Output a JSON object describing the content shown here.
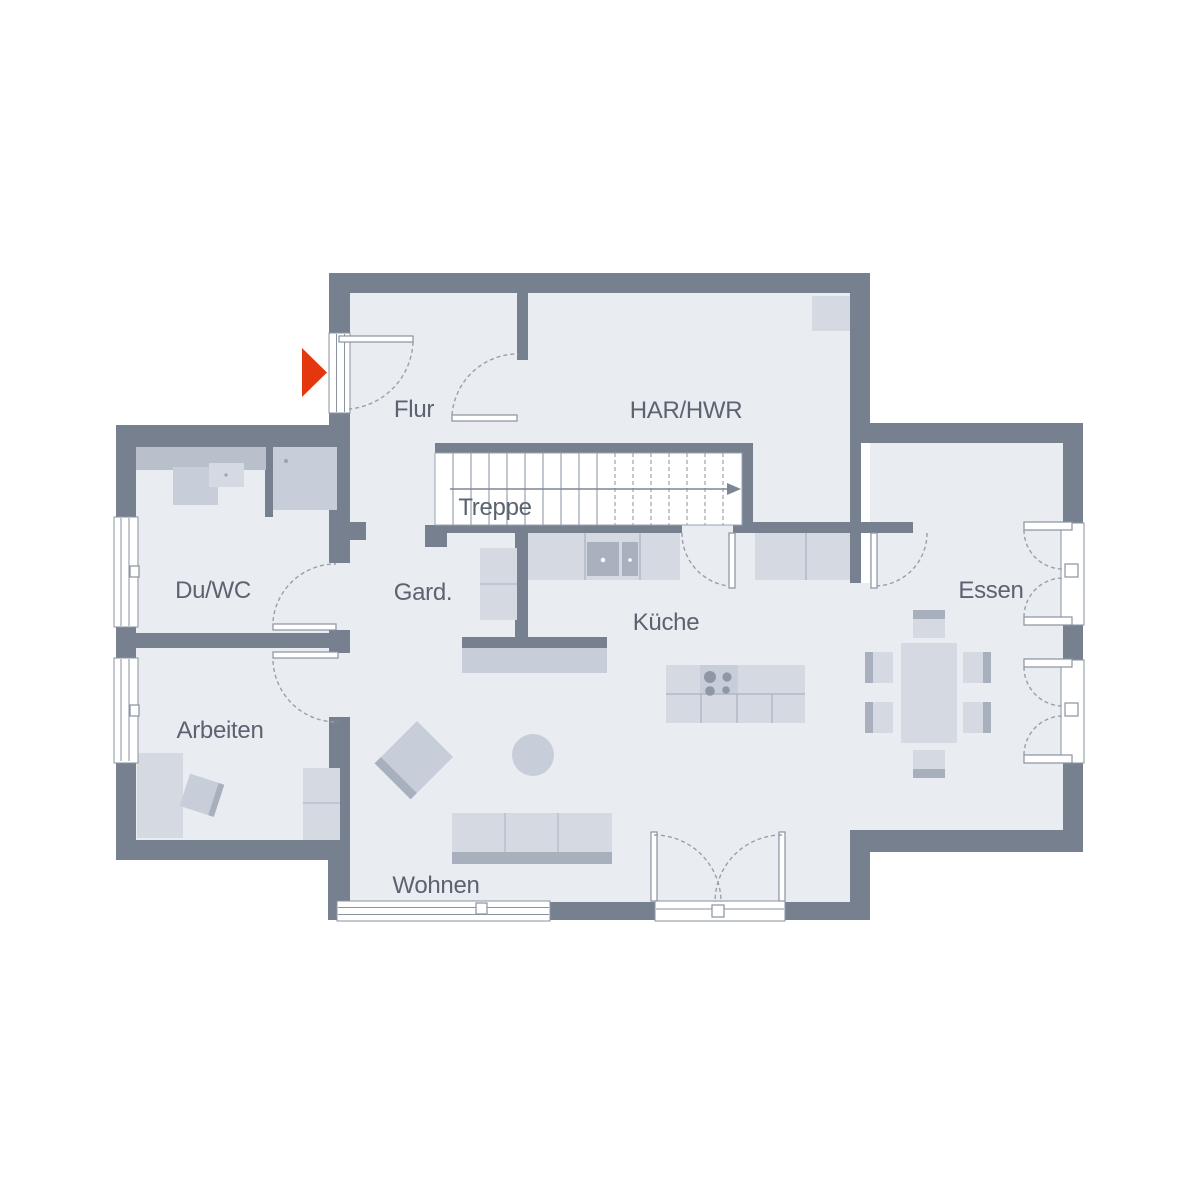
{
  "plan": {
    "type": "ground-floor-plan",
    "rooms": {
      "flur": "Flur",
      "har": "HAR/HWR",
      "treppe": "Treppe",
      "duwc": "Du/WC",
      "gard": "Gard.",
      "kueche": "Küche",
      "essen": "Essen",
      "arbeiten": "Arbeiten",
      "wohnen": "Wohnen"
    },
    "colors": {
      "wall": "#77808f",
      "floor": "#e9ecf1",
      "furniture_light": "#d5d9e2",
      "furniture_mid": "#c8ced9",
      "furniture_dark": "#a9b0bd",
      "counter": "#b9c0cb",
      "appliance": "#aab1be",
      "accent_entrance": "#e5370e",
      "label_text": "#5c6370",
      "line": "#8a93a0"
    }
  }
}
